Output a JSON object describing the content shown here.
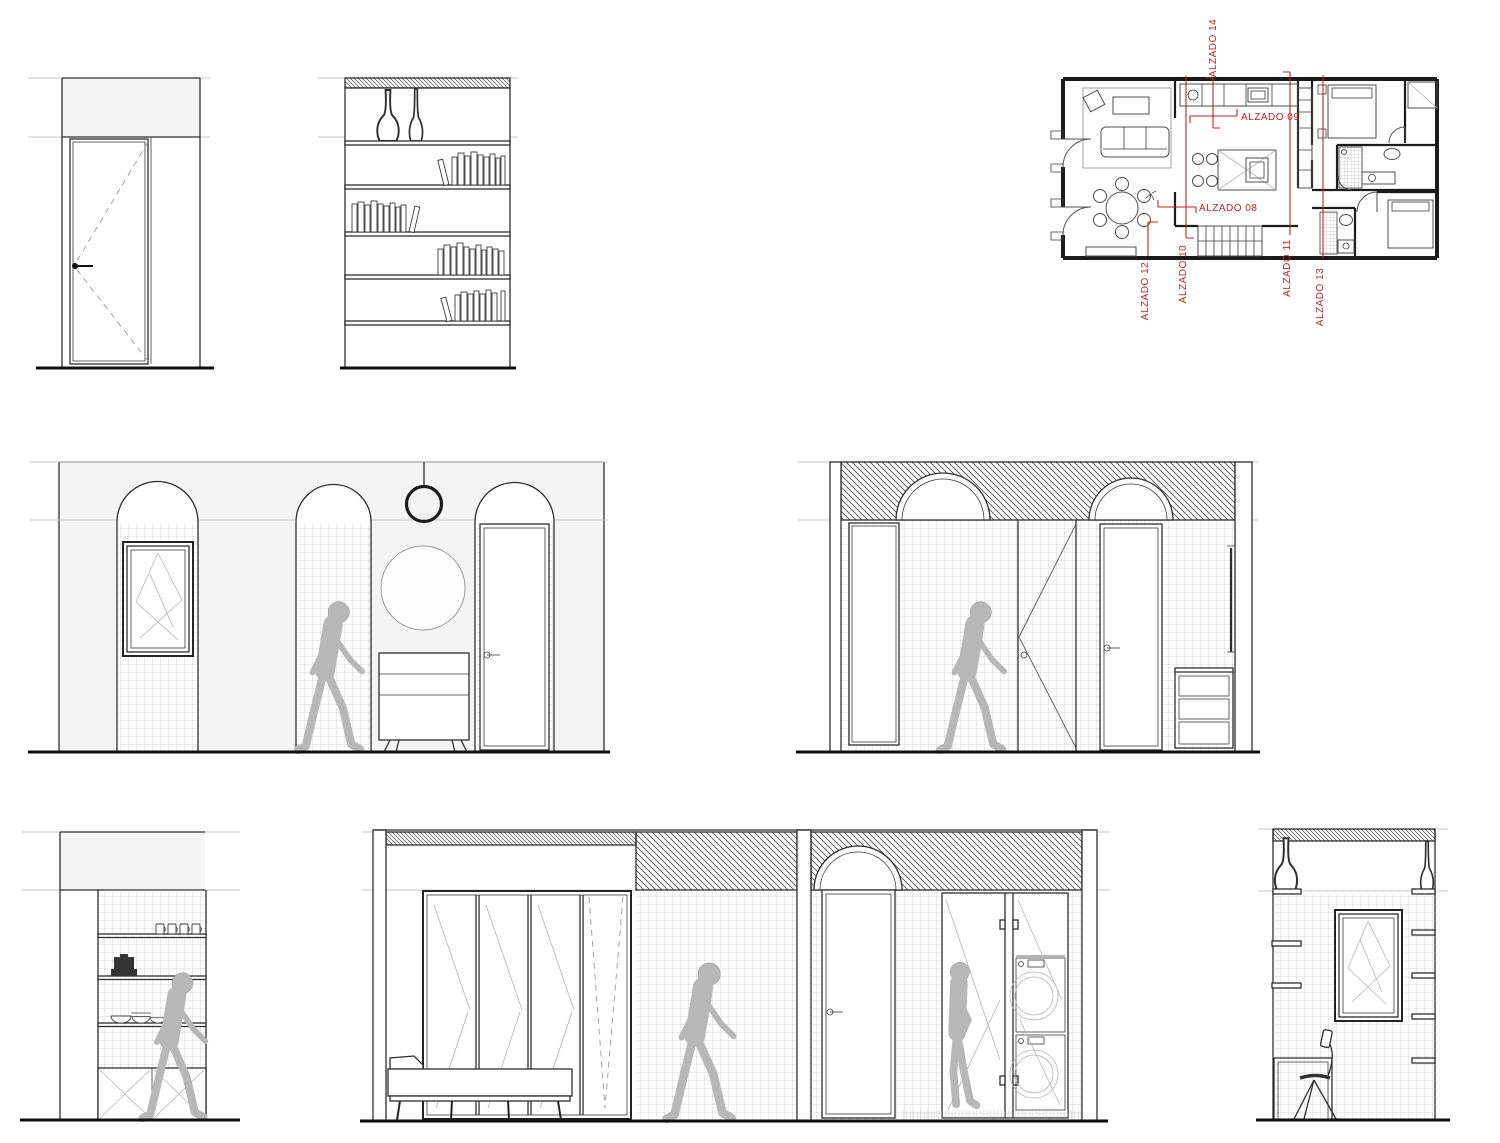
{
  "page": {
    "kind": "architectural-elevations-sheet",
    "background": "#ffffff"
  },
  "palette": {
    "annotation_red": "#c3201f",
    "line_dark": "#2e2e2e",
    "line_black": "#0f0f0f",
    "reference_gray": "#c7c7c7",
    "wall_fill": "#f4f4f4",
    "tile_line": "#cbcbcb",
    "hatch_line": "#4f4f4f",
    "person_gray": "#b7b7b7",
    "glass_line": "#b3b3b3"
  },
  "annotations": {
    "labels": [
      {
        "id": "alzado-14",
        "text": "ALZADO 14",
        "orientation": "vertical"
      },
      {
        "id": "alzado-09",
        "text": "ALZADO 09",
        "orientation": "horizontal"
      },
      {
        "id": "alzado-08",
        "text": "ALZADO 08",
        "orientation": "horizontal"
      },
      {
        "id": "alzado-12",
        "text": "ALZADO 12",
        "orientation": "vertical"
      },
      {
        "id": "alzado-10",
        "text": "ALZADO 10",
        "orientation": "vertical"
      },
      {
        "id": "alzado-11",
        "text": "ALZADO 11",
        "orientation": "vertical"
      },
      {
        "id": "alzado-13",
        "text": "ALZADO 13",
        "orientation": "vertical"
      }
    ]
  }
}
